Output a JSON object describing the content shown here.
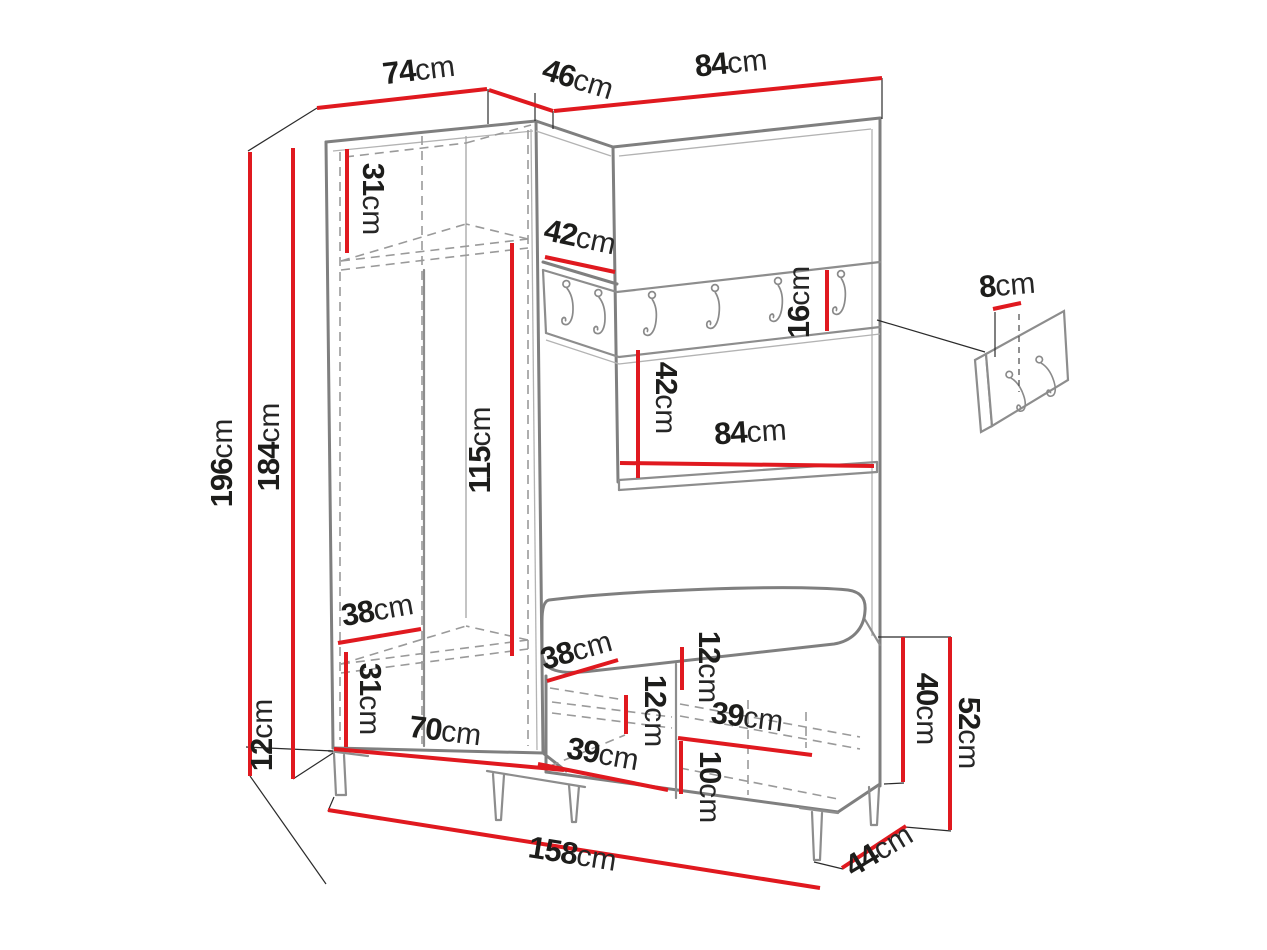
{
  "diagram_title": "hallway furniture set dimension drawing",
  "colors": {
    "dimension_red": "#e0191f",
    "outline_gray": "#7f7f7f",
    "label_black": "#1d1d1b",
    "background": "#ffffff"
  },
  "labels": [
    {
      "id": "top-width-left",
      "n": "74",
      "u": "cm"
    },
    {
      "id": "top-width-corner",
      "n": "46",
      "u": "cm"
    },
    {
      "id": "top-width-right",
      "n": "84",
      "u": "cm"
    },
    {
      "id": "total-height",
      "n": "196",
      "u": "cm"
    },
    {
      "id": "cabinet-height",
      "n": "184",
      "u": "cm"
    },
    {
      "id": "upper-shelf-height",
      "n": "31",
      "u": "cm"
    },
    {
      "id": "corner-width",
      "n": "42",
      "u": "cm"
    },
    {
      "id": "hook-rail-height",
      "n": "16",
      "u": "cm"
    },
    {
      "id": "wall-hook-spacing",
      "n": "8",
      "u": "cm"
    },
    {
      "id": "interior-height",
      "n": "115",
      "u": "cm"
    },
    {
      "id": "niche-height",
      "n": "42",
      "u": "cm"
    },
    {
      "id": "niche-width",
      "n": "84",
      "u": "cm"
    },
    {
      "id": "wardrobe-inner-depth",
      "n": "38",
      "u": "cm"
    },
    {
      "id": "lower-shelf-height",
      "n": "31",
      "u": "cm"
    },
    {
      "id": "leg-height",
      "n": "12",
      "u": "cm"
    },
    {
      "id": "interior-width",
      "n": "70",
      "u": "cm"
    },
    {
      "id": "bench-depth",
      "n": "38",
      "u": "cm"
    },
    {
      "id": "bench-inner-height",
      "n": "12",
      "u": "cm"
    },
    {
      "id": "cushion-thickness",
      "n": "12",
      "u": "cm"
    },
    {
      "id": "bench-door-left",
      "n": "39",
      "u": "cm"
    },
    {
      "id": "bench-door-right",
      "n": "39",
      "u": "cm"
    },
    {
      "id": "bench-leg-height",
      "n": "10",
      "u": "cm"
    },
    {
      "id": "bench-body-height",
      "n": "40",
      "u": "cm"
    },
    {
      "id": "bench-total-height",
      "n": "52",
      "u": "cm"
    },
    {
      "id": "total-width",
      "n": "158",
      "u": "cm"
    },
    {
      "id": "bench-side-depth",
      "n": "44",
      "u": "cm"
    }
  ]
}
